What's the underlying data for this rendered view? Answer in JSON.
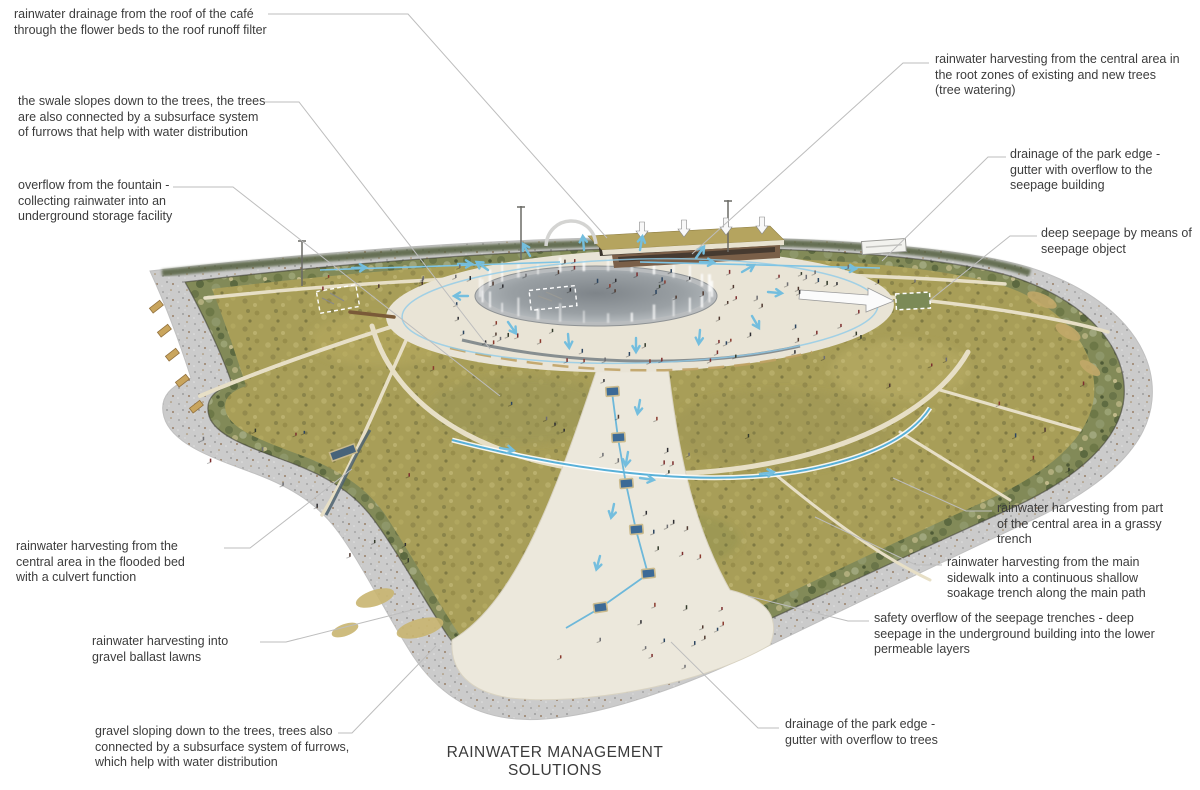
{
  "title": "RAINWATER MANAGEMENT SOLUTIONS",
  "colors": {
    "label_text": "#3c3c3c",
    "leader_line": "#bdbdbd",
    "water_flow_blue": "#74bede",
    "seepage_square_blue": "#3c6a96",
    "lawn_green": "#a89e58",
    "vegetation_green": "#828a58",
    "walkway_gray": "#cbcbcb",
    "path_cream": "#e9e3d2",
    "cafe_roof_tan": "#b5a45f"
  },
  "annotations": [
    {
      "id": "cafe-roof-drainage",
      "text": "rainwater drainage from the roof of the café through the flower beds to the roof runoff filter"
    },
    {
      "id": "swale-to-trees",
      "text": "the swale slopes down to the trees, the trees are also connected by a subsurface system of furrows that help with water distribution"
    },
    {
      "id": "fountain-overflow",
      "text": "overflow from the fountain - collecting rainwater into an underground storage facility"
    },
    {
      "id": "root-zone-harvesting",
      "text": "rainwater harvesting from the central area in the root zones of existing and new trees (tree watering)"
    },
    {
      "id": "edge-gutter-seepage-building",
      "text": "drainage of the park edge - gutter with overflow to the seepage building"
    },
    {
      "id": "deep-seepage-object",
      "text": "deep seepage by means of seepage object"
    },
    {
      "id": "grassy-trench-harvesting",
      "text": "rainwater harvesting from part of the central area in a grassy trench"
    },
    {
      "id": "sidewalk-soakage-trench",
      "text": "rainwater harvesting from the main sidewalk into a continuous shallow soakage trench along the main path"
    },
    {
      "id": "seepage-trench-overflow",
      "text": "safety overflow of the seepage trenches - deep seepage in the underground building into the lower permeable layers"
    },
    {
      "id": "flooded-bed-harvesting",
      "text": "rainwater harvesting from the central area in the flooded bed with a culvert function"
    },
    {
      "id": "gravel-ballast-lawns",
      "text": "rainwater harvesting into gravel ballast lawns"
    },
    {
      "id": "gravel-slope-furrows",
      "text": "gravel sloping down to the trees, trees also connected by a subsurface system of furrows, which help with water distribution"
    },
    {
      "id": "edge-gutter-trees",
      "text": "drainage of the park edge - gutter with overflow to trees"
    }
  ]
}
